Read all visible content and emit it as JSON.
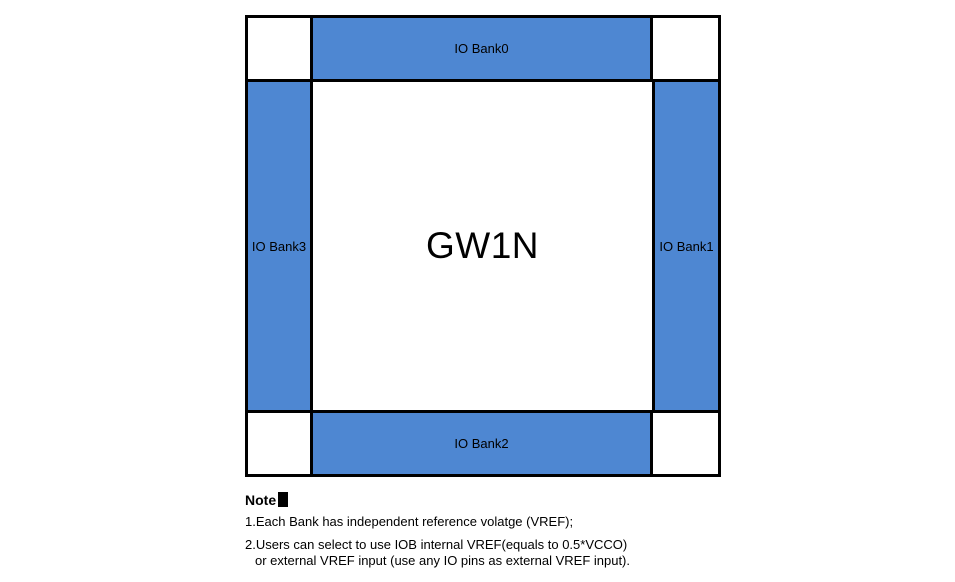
{
  "diagram": {
    "chip_label": "GW1N",
    "banks": {
      "top": "IO Bank0",
      "right": "IO Bank1",
      "bottom": "IO Bank2",
      "left": "IO Bank3"
    },
    "colors": {
      "bank_fill": "#4E87D2",
      "border": "#000000",
      "background": "#FFFFFF"
    }
  },
  "note": {
    "heading": "Note",
    "heading_glyph": "filled-square",
    "items": [
      "1.Each Bank has independent reference volatge (VREF);",
      "2.Users can select to use IOB internal VREF(equals to 0.5*VCCO)",
      "or external VREF input (use any IO pins as external VREF input)."
    ]
  }
}
